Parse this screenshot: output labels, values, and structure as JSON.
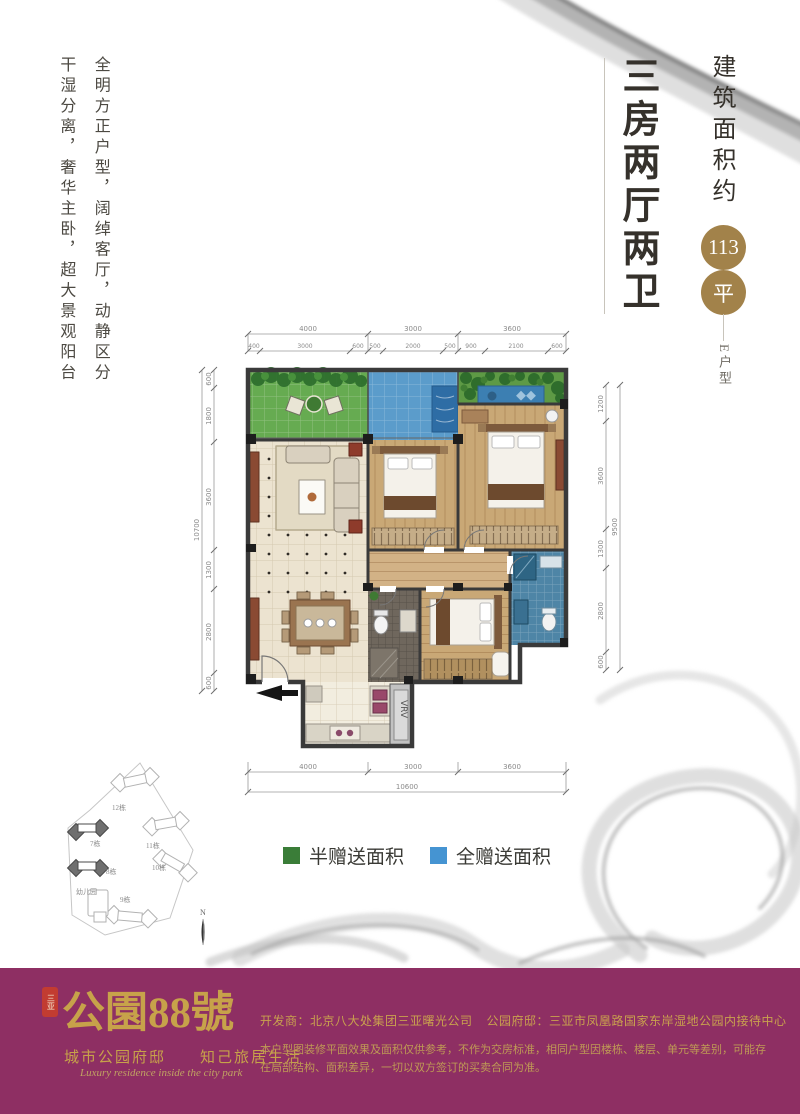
{
  "header": {
    "title": "三房两厅两卫",
    "area_label": "建筑面积约",
    "area_value": "113",
    "area_unit": "平",
    "unit_type": "E户型"
  },
  "intro": {
    "line1": "全明方正户型，阔绰客厅，动静区分",
    "line2": "干湿分离，奢华主卧，超大景观阳台"
  },
  "plan": {
    "vrv": "VRV",
    "dims": {
      "top_main": [
        "4000",
        "3000",
        "3600"
      ],
      "top_sub": [
        "400",
        "3000",
        "600",
        "500",
        "2000",
        "500",
        "900",
        "2100",
        "600"
      ],
      "left": [
        "600",
        "1800",
        "3600",
        "1300",
        "2800",
        "600"
      ],
      "left_total": "10700",
      "right": [
        "1200",
        "3600",
        "1300",
        "2800",
        "600"
      ],
      "right_total": "9500",
      "bottom": [
        "4000",
        "3000",
        "3600"
      ],
      "bottom_total": "10600"
    }
  },
  "legend": {
    "half": "半赠送面积",
    "half_color": "#3a7d38",
    "full": "全赠送面积",
    "full_color": "#4594d2"
  },
  "sitemap": {
    "b7": "7栋",
    "b8": "8栋",
    "b9": "9栋",
    "b10": "10栋",
    "b11": "11栋",
    "b12": "12栋",
    "kindergarten": "幼儿园",
    "north": "N"
  },
  "footer": {
    "seal": "三亚",
    "logo": "公園88號",
    "slogan_cn": "城市公园府邸　　知己旅居生活",
    "slogan_en": "Luxury residence inside the city park",
    "developer": "开发商：北京八大处集团三亚曙光公司",
    "office": "公园府邸：三亚市凤凰路国家东岸湿地公园内接待中心",
    "disclaimer": "本户型图装修平面效果及面积仅供参考，不作为交房标准，相同户型因楼栋、楼层、单元等差别，可能存在局部结构、面积差异，一切以双方签订的买卖合同为准。"
  }
}
